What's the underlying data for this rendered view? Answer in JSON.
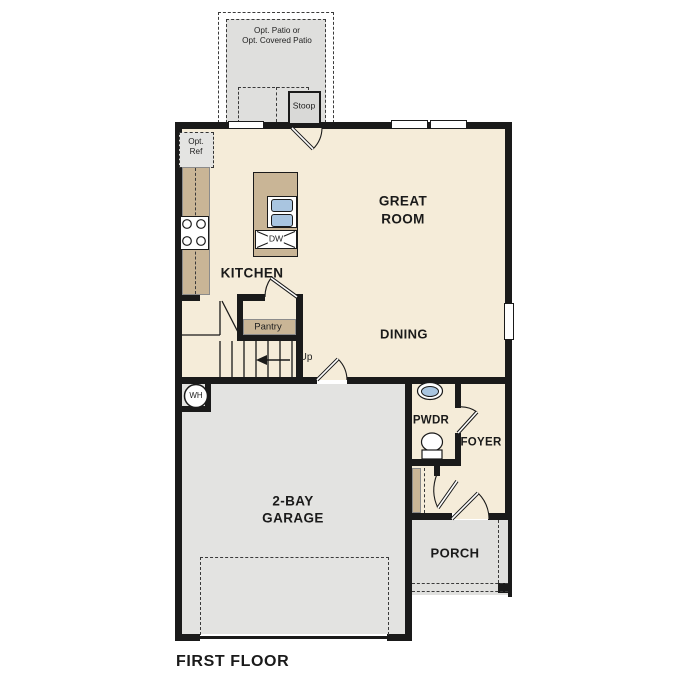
{
  "plan": {
    "title": "FIRST FLOOR",
    "rooms": {
      "great_room": {
        "line1": "GREAT",
        "line2": "ROOM"
      },
      "kitchen": {
        "label": "KITCHEN"
      },
      "dining": {
        "label": "DINING"
      },
      "pantry": {
        "label": "Pantry"
      },
      "pwdr": {
        "label": "PWDR"
      },
      "foyer": {
        "label": "FOYER"
      },
      "garage": {
        "line1": "2-BAY",
        "line2": "GARAGE"
      },
      "porch": {
        "label": "PORCH"
      },
      "stoop": {
        "label": "Stoop"
      },
      "patio": {
        "line1": "Opt. Patio or",
        "line2": "Opt. Covered Patio"
      }
    },
    "annotations": {
      "up": "Up",
      "dw": "DW",
      "wh": "WH",
      "opt_ref_line1": "Opt.",
      "opt_ref_line2": "Ref"
    },
    "colors": {
      "wall": "#1a1a1a",
      "floor": "#f5ecd9",
      "garage_floor": "#e3e3e1",
      "porch_floor": "#e0e0de",
      "patio": "#dfdfdd",
      "cabinet_tan": "#c9b596",
      "sink_blue": "#a9c5e0"
    }
  }
}
